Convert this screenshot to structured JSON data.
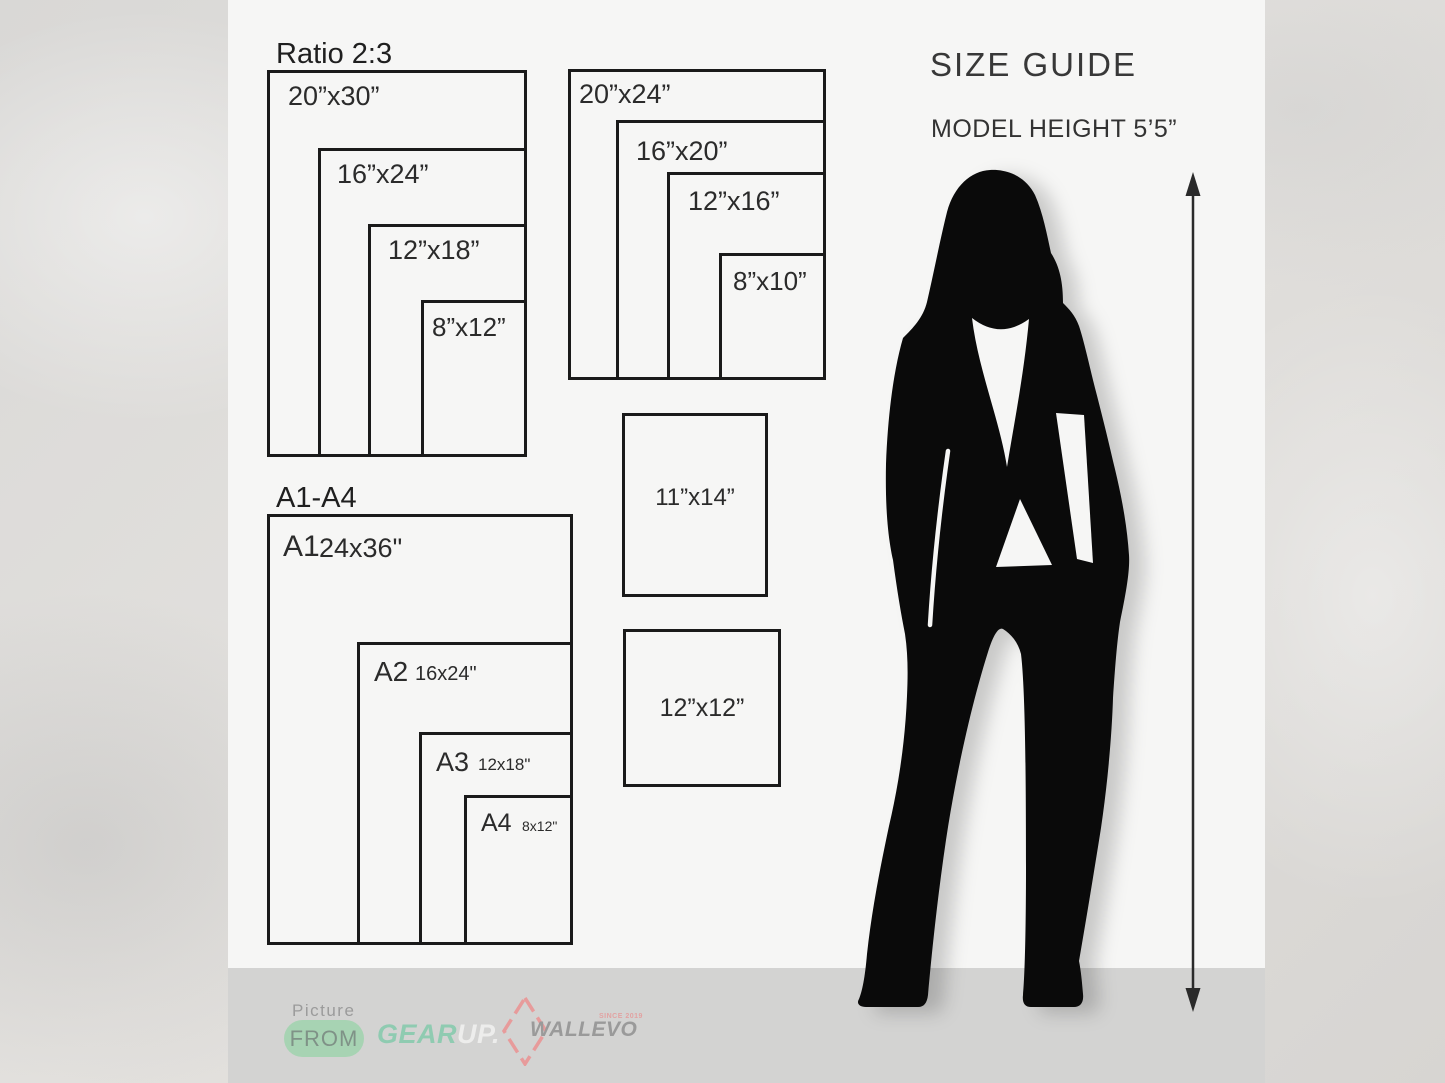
{
  "title": "SIZE GUIDE",
  "model": {
    "height_label": "MODEL HEIGHT 5’5”"
  },
  "groups": {
    "ratio": {
      "heading": "Ratio 2:3",
      "boxes": [
        {
          "label": "20”x30”"
        },
        {
          "label": "16”x24”"
        },
        {
          "label": "12”x18”"
        },
        {
          "label": "8”x12”"
        }
      ]
    },
    "standard": {
      "boxes": [
        {
          "label": "20”x24”"
        },
        {
          "label": "16”x20”"
        },
        {
          "label": "12”x16”"
        },
        {
          "label": "8”x10”"
        }
      ]
    },
    "a_series": {
      "heading": "A1-A4",
      "boxes": [
        {
          "name": "A1",
          "size": "24x36\""
        },
        {
          "name": "A2",
          "size": "16x24\""
        },
        {
          "name": "A3",
          "size": "12x18\""
        },
        {
          "name": "A4",
          "size": "8x12\""
        }
      ]
    },
    "single": {
      "boxes": [
        {
          "label": "11”x14”"
        },
        {
          "label": "12”x12”"
        }
      ]
    }
  },
  "footer": {
    "picture": "Picture",
    "from": "FROM",
    "gear": "GEAR",
    "up": "UP.",
    "brand": "WALLEVO",
    "since": "SINCE 2019"
  },
  "colors": {
    "panel": "#f6f6f5",
    "footer_band": "#d3d3d2",
    "box_border": "#1a1a1a",
    "accent_green": "#a7d3b3",
    "accent_mint": "#8fcbb1",
    "accent_pink": "#e79b9b",
    "silhouette": "#0a0a0a"
  }
}
